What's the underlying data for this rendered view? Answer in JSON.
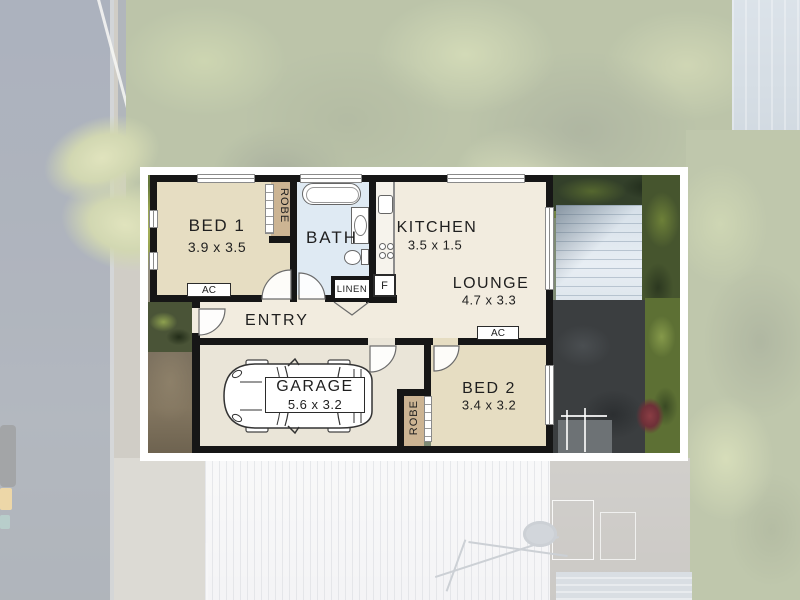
{
  "floor_plan": {
    "rooms": [
      {
        "name": "BED 1",
        "dims": "3.9 x 3.5"
      },
      {
        "name": "BATH",
        "dims": ""
      },
      {
        "name": "KITCHEN",
        "dims": "3.5 x 1.5"
      },
      {
        "name": "LOUNGE",
        "dims": "4.7 x 3.3"
      },
      {
        "name": "ENTRY",
        "dims": ""
      },
      {
        "name": "GARAGE",
        "dims": "5.6 x 3.2"
      },
      {
        "name": "BED 2",
        "dims": "3.4 x 3.2"
      }
    ],
    "labels": {
      "robe_bed1": "ROBE",
      "robe_bed2": "ROBE",
      "linen": "LINEN",
      "fridge": "F",
      "ac_bed1": "AC",
      "ac_lounge": "AC"
    },
    "colors": {
      "wall": "#161616",
      "bedroom_fill": "#e6ddc2",
      "bath_fill": "#dfeaf3",
      "living_fill": "#f2ecdf",
      "garage_fill": "#eae5d8",
      "robe_fill": "#ccb493",
      "frame": "#ffffff"
    }
  }
}
